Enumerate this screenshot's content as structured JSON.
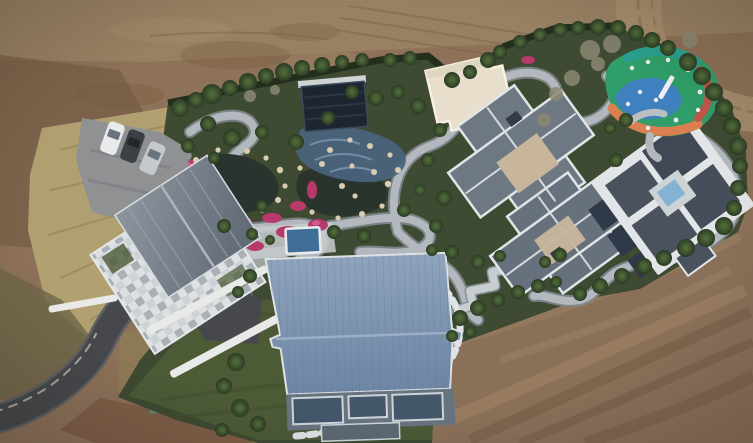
{
  "scene": {
    "type": "aerial-drone-photo",
    "subject": "walled luxury estate compound seen from directly above, landscaped gardens with ponds and winding paths, surrounded by bare graded earth",
    "objects": [
      "bare-dirt-terrain",
      "plowed-furrows",
      "dirt-access-road",
      "dry-grass-scrub",
      "garden-compound",
      "boundary-hedge",
      "lawn",
      "asphalt-driveway",
      "parking-pad",
      "three-parked-cars",
      "stone-courtyard-house",
      "dark-pool-pavilion",
      "mosaic-pool",
      "koi-ponds",
      "pink-flower-beds",
      "white-garden-rocks",
      "cream-flat-roof-building",
      "cross-roof-mansion",
      "white-trim-mansion-with-courtyard-pool",
      "blue-metal-roof-barn",
      "small-swimming-pool",
      "colorful-playground",
      "stone-steps",
      "stepping-stone-path",
      "garden-trees",
      "bare-winter-trees"
    ],
    "counts": {
      "cars": 3,
      "main_buildings": 5,
      "ponds": 2,
      "pools": 3
    }
  },
  "palette": {
    "dirt_base": "#8d7158",
    "dirt_top_light": "#9a8265",
    "dirt_dark_patch": "#6f563f",
    "dirt_road": "#a58b6c",
    "dirt_track": "#8a7053",
    "dirt_bottom": "#8b7059",
    "dirt_ridge_dark": "#6b4f39",
    "dirt_ridge_light": "#a1866a",
    "dirt_wet_red": "#7a5742",
    "dry_grass": "#b3a272",
    "dry_grass_dark": "#8f7f55",
    "scrub_olive": "#6d6748",
    "garden_green": "#3e4a31",
    "lawn_green": "#4c5a36",
    "hedge_dark": "#232e1d",
    "tree_core": "#4e6838",
    "tree_edge": "#2b3b24",
    "bare_tree": "#8b8873",
    "path_gray": "#b2b8bd",
    "path_casing": "#80878d",
    "stone_step": "#c8cdd1",
    "plaza_stone": "#c7cccf",
    "pond_dark": "#2a332d",
    "mosaic_blue": "#4a647e",
    "mosaic_wave": "#7e98b4",
    "pavilion_navy": "#1d2531",
    "pool_blue": "#3f6f96",
    "court_pool_blue": "#84b2d3",
    "flower_pink": "#b73a6b",
    "flower_pink_light": "#d4679a",
    "rock_tan": "#d8ccb2",
    "cream_roof": "#e7dfcb",
    "cream_trim": "#f6f1e3",
    "roof_gray": "#6e7883",
    "roof_gray_dark": "#4a525e",
    "roof_darker": "#3f4854",
    "roof_trim": "#e2e5e7",
    "beige_flat": "#c8b69c",
    "skylight_dark": "#323c49",
    "solar_panel": "#2f3947",
    "courtyard_stone": "#cdd2d5",
    "courtyard_stone_dark": "#aab1b6",
    "slate_roof": "#5d6772",
    "slate_roof_light": "#8d959e",
    "barn_roof_light": "#8fa3bc",
    "barn_roof_dark": "#6d86a3",
    "barn_seam": "#5d7795",
    "barn_facade": "#67737f",
    "window_glass": "#43566a",
    "window_frame": "#ccd4da",
    "deck_gray": "#5c6873",
    "asphalt": "#46484b",
    "asphalt_edge": "#5d5f62",
    "curb_white": "#cfcec6",
    "parking_pad": "#8f9193",
    "car_white": "#e8eaec",
    "car_dark": "#3c4045",
    "car_silver": "#c6c9cc",
    "car_glass": "#6a7480",
    "pg_green": "#2f9e68",
    "pg_blue": "#3f80bf",
    "pg_orange": "#d97f51",
    "pg_red": "#c0564a",
    "pg_teal": "#2aa08e",
    "pg_equipment": "#eef0f2",
    "paint_teal": "#3fae9a",
    "vignette": "#140f0a"
  }
}
